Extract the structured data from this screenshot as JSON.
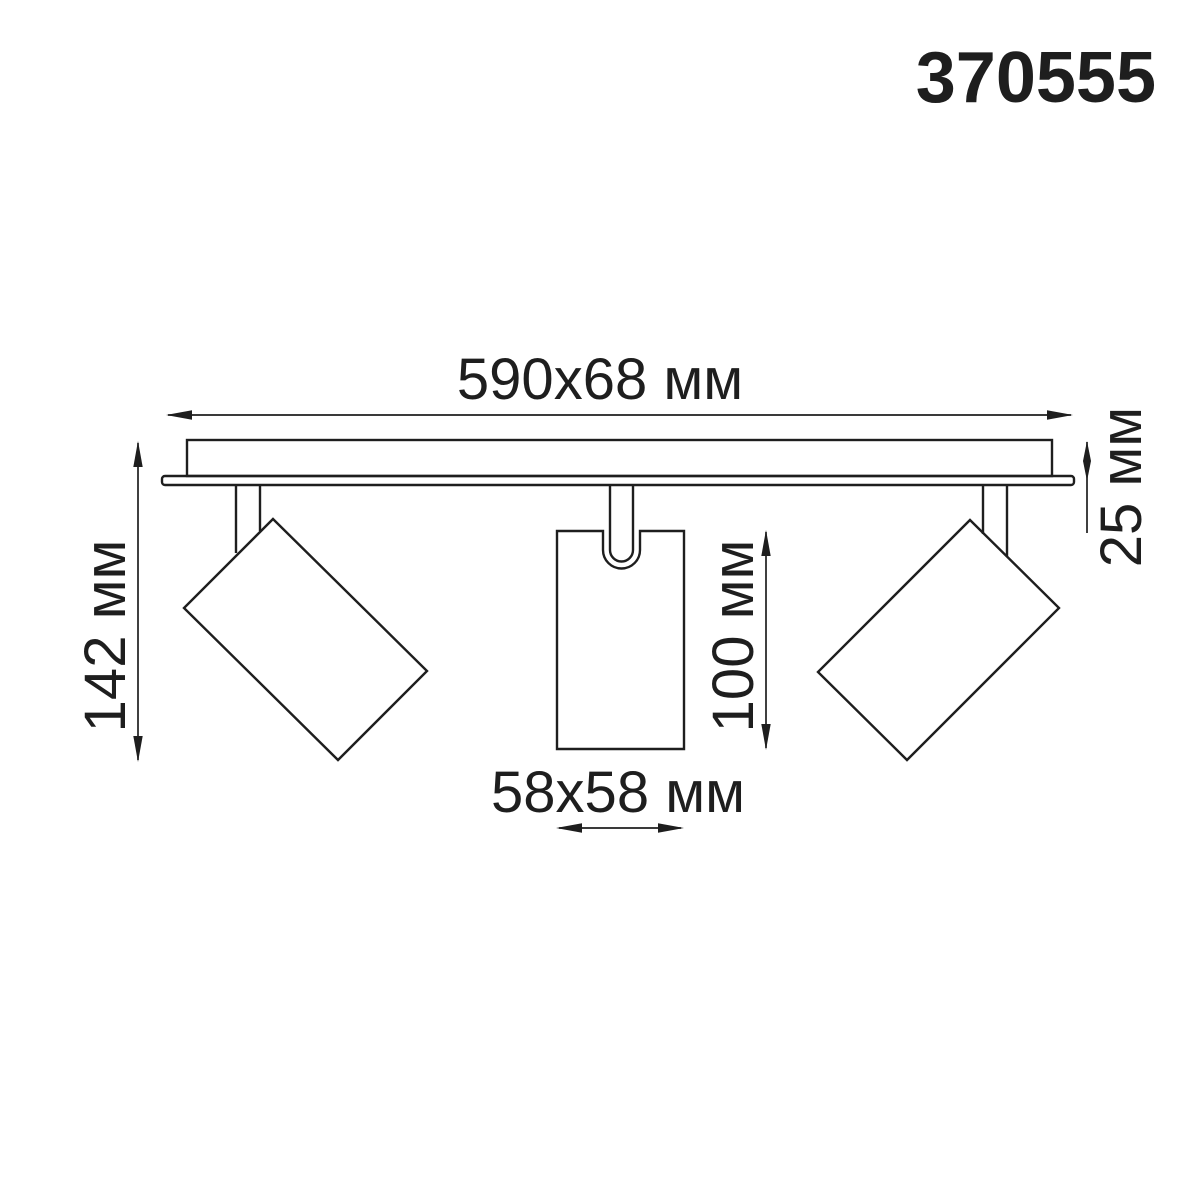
{
  "product": {
    "code": "370555"
  },
  "dimensions": {
    "base": {
      "label": "590x68 мм"
    },
    "overall_height": {
      "label": "142 мм"
    },
    "base_thickness": {
      "label": "25 мм"
    },
    "spot_body_height": {
      "label": "100 мм"
    },
    "spot_body_size": {
      "label": "58x58 мм"
    }
  },
  "colors": {
    "ink": "#1e1e1e",
    "background": "#ffffff"
  }
}
